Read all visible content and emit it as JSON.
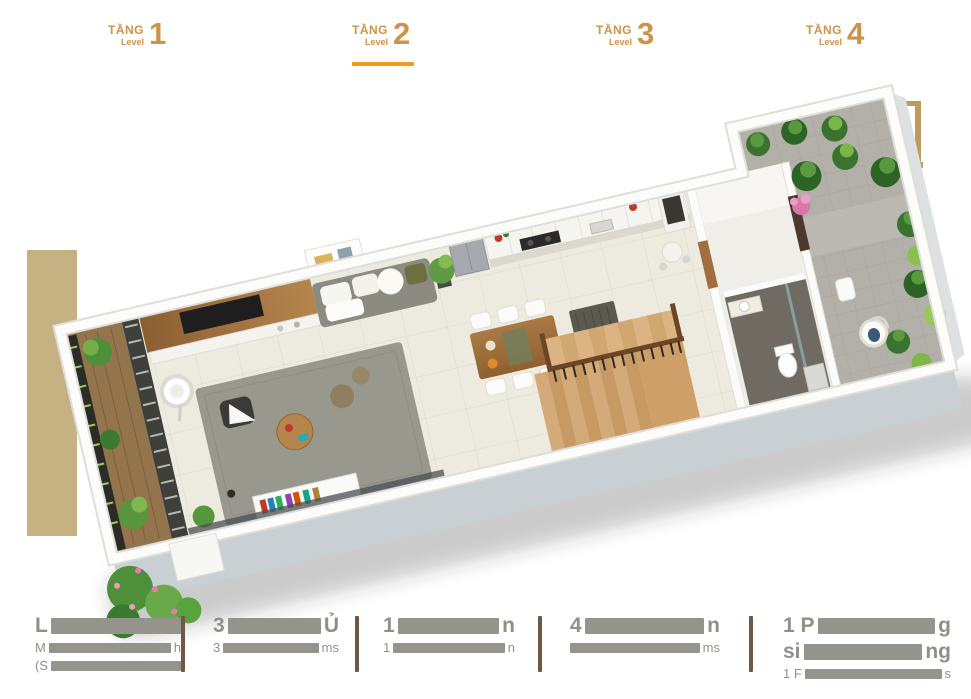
{
  "page": {
    "background": "#ffffff"
  },
  "tabs": {
    "text_color": "#cd9348",
    "active_underline_color": "#f5991d",
    "items": [
      {
        "label": "TẦNG",
        "sublabel": "Level",
        "number": "1",
        "active": false
      },
      {
        "label": "TẦNG",
        "sublabel": "Level",
        "number": "2",
        "active": true
      },
      {
        "label": "TẦNG",
        "sublabel": "Level",
        "number": "3",
        "active": false
      },
      {
        "label": "TẦNG",
        "sublabel": "Level",
        "number": "4",
        "active": false
      }
    ]
  },
  "floor_plan": {
    "kind": "3d-isometric-floor-plan-render",
    "shown_level_number": "2"
  },
  "footer": {
    "divider_color": "#6f5846",
    "text_color": "#90908a",
    "redaction_color": "#94948c",
    "note": "labels are partially obscured by gray blocks in the source image; only edge characters are visible",
    "sections": [
      {
        "name": "stat-1",
        "lines": [
          {
            "style": "lg",
            "start": "L",
            "end": ""
          },
          {
            "style": "sm",
            "start": "M",
            "end": "h"
          },
          {
            "style": "sm",
            "start": "(S",
            "end": ""
          }
        ]
      },
      {
        "name": "stat-2",
        "lines": [
          {
            "style": "lg",
            "start": "3",
            "end": "Ủ"
          },
          {
            "style": "sm",
            "start": "3",
            "end": "ms"
          }
        ]
      },
      {
        "name": "stat-3",
        "lines": [
          {
            "style": "lg",
            "start": "1",
            "end": "n"
          },
          {
            "style": "sm",
            "start": "1",
            "end": "n"
          }
        ]
      },
      {
        "name": "stat-4",
        "lines": [
          {
            "style": "lg",
            "start": "4",
            "end": "n"
          },
          {
            "style": "sm",
            "start": "",
            "end": "ms"
          }
        ]
      },
      {
        "name": "stat-5",
        "lines": [
          {
            "style": "lg",
            "start": "1 P",
            "end": "g"
          },
          {
            "style": "lg",
            "start": "si",
            "end": "ng"
          },
          {
            "style": "sm",
            "start": "1 F",
            "end": "s"
          }
        ]
      }
    ]
  }
}
